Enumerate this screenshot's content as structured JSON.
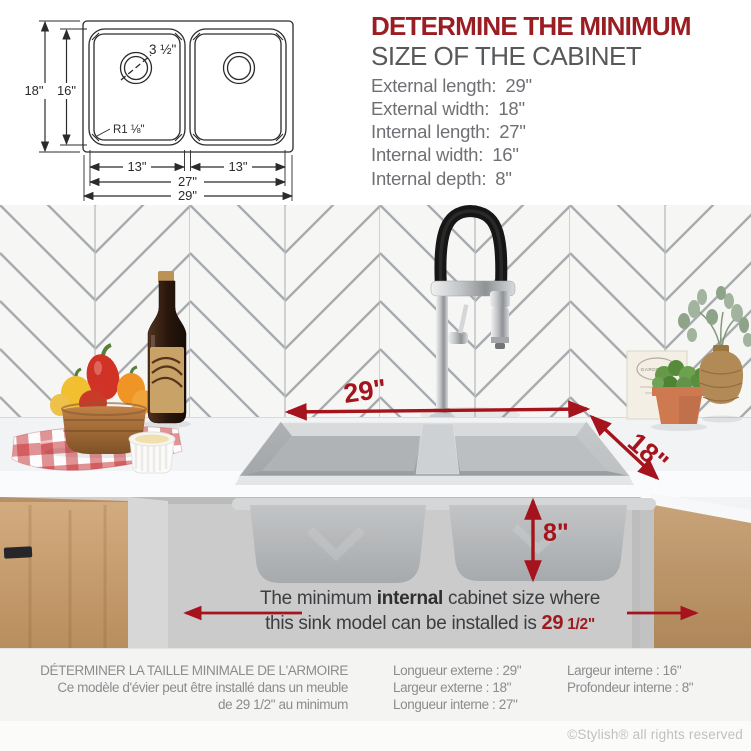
{
  "colors": {
    "brand_red": "#9a1d23",
    "annotation_red": "#a5131c",
    "heading_grey": "#57585a",
    "text_grey": "#6f7074",
    "french_grey": "#8b8c8f"
  },
  "diagram": {
    "outer_length": "29\"",
    "inner_length": "27\"",
    "left_bowl_width": "13\"",
    "right_bowl_width": "13\"",
    "outer_width": "18\"",
    "inner_width": "16\"",
    "drain_size": "3 ½\"",
    "corner_radius": "R1 ⅛\""
  },
  "header": {
    "title_line1": "DETERMINE THE MINIMUM",
    "title_line2": "SIZE OF THE CABINET",
    "specs": [
      {
        "label": "External length:",
        "value": "29\""
      },
      {
        "label": "External width:",
        "value": "18\""
      },
      {
        "label": "Internal length:",
        "value": "27\""
      },
      {
        "label": "Internal width:",
        "value": "16\""
      },
      {
        "label": "Internal depth:",
        "value": "8\""
      }
    ]
  },
  "photo": {
    "annotations": {
      "external_length": "29\"",
      "external_width": "18\"",
      "internal_depth": "8\""
    },
    "garden_box_label": "GARDENING",
    "caption": {
      "line1_pre": "The minimum ",
      "line1_bold": "internal",
      "line1_post": " cabinet size where",
      "line2_pre": "this sink model can be installed is ",
      "line2_value_main": "29",
      "line2_value_frac": "1/2\""
    }
  },
  "footer": {
    "fr_heading": "DÉTERMINER LA TAILLE MINIMALE DE L'ARMOIRE",
    "fr_sub1": "Ce modèle d'évier peut être installé dans un meuble",
    "fr_sub2": "de 29 1/2\" au minimum",
    "fr_specs_left": [
      {
        "label": "Longueur externe :",
        "value": "29\""
      },
      {
        "label": "Largeur externe :",
        "value": "18\""
      },
      {
        "label": "Longueur interne :",
        "value": "27\""
      }
    ],
    "fr_specs_right": [
      {
        "label": "Largeur interne :",
        "value": "16\""
      },
      {
        "label": "Profondeur interne :",
        "value": "8\""
      }
    ],
    "copyright": "©Stylish® all rights reserved"
  }
}
